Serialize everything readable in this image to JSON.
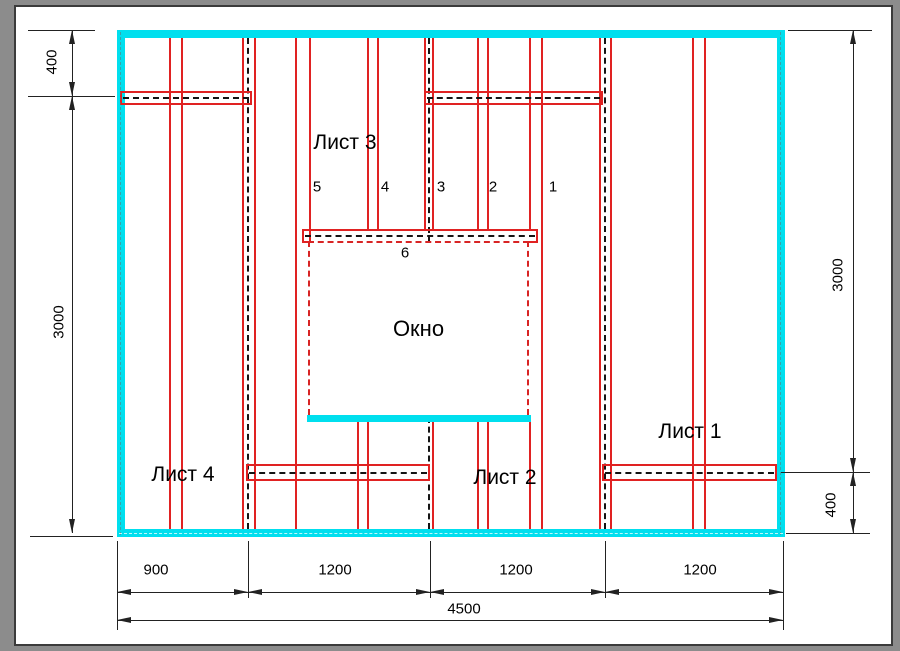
{
  "drawing": {
    "title_hint": "wall sheathing layout",
    "sheets": [
      {
        "label": "Лист 1"
      },
      {
        "label": "Лист 2"
      },
      {
        "label": "Лист 3"
      },
      {
        "label": "Лист 4"
      }
    ],
    "window_label": "Окно",
    "stud_numbers": [
      "1",
      "2",
      "3",
      "4",
      "5",
      "6"
    ],
    "dimensions": {
      "left_top": "400",
      "left_height": "3000",
      "right_height": "3000",
      "right_bottom": "400",
      "bottom_segments": [
        "900",
        "1200",
        "1200",
        "1200"
      ],
      "bottom_total": "4500"
    },
    "colors": {
      "wall_outline": "#00dfee",
      "profiles": "#e02222",
      "centerline": "#141414",
      "dimension": "#222222"
    }
  }
}
